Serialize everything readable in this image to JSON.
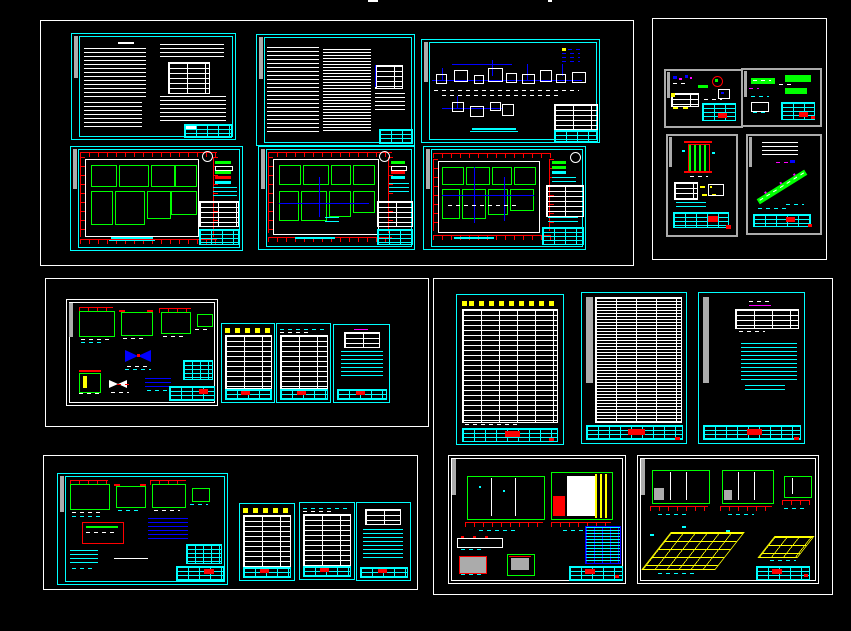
{
  "window": {
    "description": "CAD model-space viewport showing a wastewater treatment plant drawing set arranged as sheet groups on a black canvas",
    "width": 851,
    "height": 631,
    "background": "#000000"
  },
  "palette": {
    "bg": "#000000",
    "white": "#FFFFFF",
    "cyan": "#00FFFF",
    "red": "#FF0000",
    "green": "#00FF00",
    "yellow": "#FFFF00",
    "blue": "#0000FF",
    "magenta": "#FF00FF",
    "gray": "#ABABAB"
  },
  "groups": [
    {
      "name": "plans-and-flow-group",
      "frame_color": "#FFFFFF",
      "rect": {
        "x": 40,
        "y": 20,
        "w": 592,
        "h": 244
      },
      "sheets": [
        {
          "name": "notes-sheet-1",
          "kind": "text-notes",
          "frame": "cyan",
          "rect": {
            "x": 70,
            "y": 32,
            "w": 163,
            "h": 105
          }
        },
        {
          "name": "notes-sheet-2",
          "kind": "text-notes",
          "frame": "cyan",
          "rect": {
            "x": 255,
            "y": 33,
            "w": 157,
            "h": 110
          }
        },
        {
          "name": "process-flow-diagram-sheet",
          "kind": "flow-diagram",
          "frame": "cyan",
          "rect": {
            "x": 420,
            "y": 38,
            "w": 177,
            "h": 102
          }
        },
        {
          "name": "floor-plan-sheet-1",
          "kind": "floor-plan",
          "frame": "cyan",
          "rect": {
            "x": 69,
            "y": 145,
            "w": 171,
            "h": 103
          }
        },
        {
          "name": "floor-plan-sheet-2",
          "kind": "floor-plan",
          "frame": "cyan",
          "rect": {
            "x": 257,
            "y": 145,
            "w": 155,
            "h": 102
          }
        },
        {
          "name": "floor-plan-sheet-3",
          "kind": "floor-plan-piping",
          "frame": "cyan",
          "rect": {
            "x": 422,
            "y": 145,
            "w": 161,
            "h": 102
          }
        }
      ]
    },
    {
      "name": "detail-sheets-group",
      "frame_color": "#FFFFFF",
      "rect": {
        "x": 652,
        "y": 18,
        "w": 173,
        "h": 240
      },
      "sheets": [
        {
          "name": "detail-sheet-a",
          "kind": "detail",
          "frame": "gray",
          "rect": {
            "x": 663,
            "y": 68,
            "w": 75,
            "h": 55
          }
        },
        {
          "name": "detail-sheet-b",
          "kind": "detail",
          "frame": "gray",
          "rect": {
            "x": 740,
            "y": 67,
            "w": 77,
            "h": 55
          }
        },
        {
          "name": "detail-sheet-c",
          "kind": "detail",
          "frame": "gray",
          "rect": {
            "x": 665,
            "y": 133,
            "w": 68,
            "h": 99
          }
        },
        {
          "name": "detail-sheet-d",
          "kind": "detail-piping",
          "frame": "gray",
          "rect": {
            "x": 745,
            "y": 133,
            "w": 72,
            "h": 97
          }
        }
      ]
    },
    {
      "name": "details-and-schedules-group-upper",
      "frame_color": "#FFFFFF",
      "rect": {
        "x": 45,
        "y": 278,
        "w": 382,
        "h": 147
      },
      "sheets": [
        {
          "name": "installation-details-sheet",
          "kind": "detail",
          "frame": "white",
          "rect": {
            "x": 65,
            "y": 298,
            "w": 150,
            "h": 105
          }
        },
        {
          "name": "schedule-table-sheet-1",
          "kind": "table",
          "frame": "cyan",
          "rect": {
            "x": 220,
            "y": 322,
            "w": 52,
            "h": 78
          }
        },
        {
          "name": "schedule-table-sheet-2",
          "kind": "table",
          "frame": "cyan",
          "rect": {
            "x": 275,
            "y": 322,
            "w": 53,
            "h": 78
          }
        },
        {
          "name": "notes-table-sheet",
          "kind": "table-notes",
          "frame": "cyan",
          "rect": {
            "x": 332,
            "y": 323,
            "w": 55,
            "h": 77
          }
        }
      ]
    },
    {
      "name": "schedules-and-sections-group",
      "frame_color": "#FFFFFF",
      "rect": {
        "x": 433,
        "y": 278,
        "w": 398,
        "h": 315
      },
      "sheets": [
        {
          "name": "equipment-schedule-sheet",
          "kind": "table",
          "frame": "cyan",
          "rect": {
            "x": 455,
            "y": 293,
            "w": 106,
            "h": 149
          }
        },
        {
          "name": "material-schedule-sheet",
          "kind": "table",
          "frame": "cyan",
          "rect": {
            "x": 580,
            "y": 291,
            "w": 104,
            "h": 150
          }
        },
        {
          "name": "general-notes-sheet",
          "kind": "table-notes",
          "frame": "cyan",
          "rect": {
            "x": 697,
            "y": 291,
            "w": 105,
            "h": 150
          }
        },
        {
          "name": "sections-details-sheet",
          "kind": "sections",
          "frame": "white",
          "rect": {
            "x": 447,
            "y": 454,
            "w": 176,
            "h": 127
          }
        },
        {
          "name": "elevations-isometric-sheet",
          "kind": "isometric",
          "frame": "white",
          "rect": {
            "x": 636,
            "y": 454,
            "w": 180,
            "h": 127
          }
        }
      ]
    },
    {
      "name": "details-and-schedules-group-lower",
      "frame_color": "#FFFFFF",
      "rect": {
        "x": 43,
        "y": 455,
        "w": 373,
        "h": 133
      },
      "sheets": [
        {
          "name": "equipment-details-sheet",
          "kind": "detail",
          "frame": "cyan",
          "rect": {
            "x": 56,
            "y": 472,
            "w": 169,
            "h": 110
          }
        },
        {
          "name": "schedule-table-sheet-3",
          "kind": "table",
          "frame": "cyan",
          "rect": {
            "x": 238,
            "y": 502,
            "w": 54,
            "h": 76
          }
        },
        {
          "name": "schedule-table-sheet-4",
          "kind": "table",
          "frame": "cyan",
          "rect": {
            "x": 298,
            "y": 501,
            "w": 54,
            "h": 76
          }
        },
        {
          "name": "notes-table-sheet-2",
          "kind": "table-notes",
          "frame": "cyan",
          "rect": {
            "x": 355,
            "y": 501,
            "w": 53,
            "h": 77
          }
        }
      ]
    }
  ],
  "legend_note": "All lettering in the drawing is below legible resolution; title blocks carry red approval stamps"
}
